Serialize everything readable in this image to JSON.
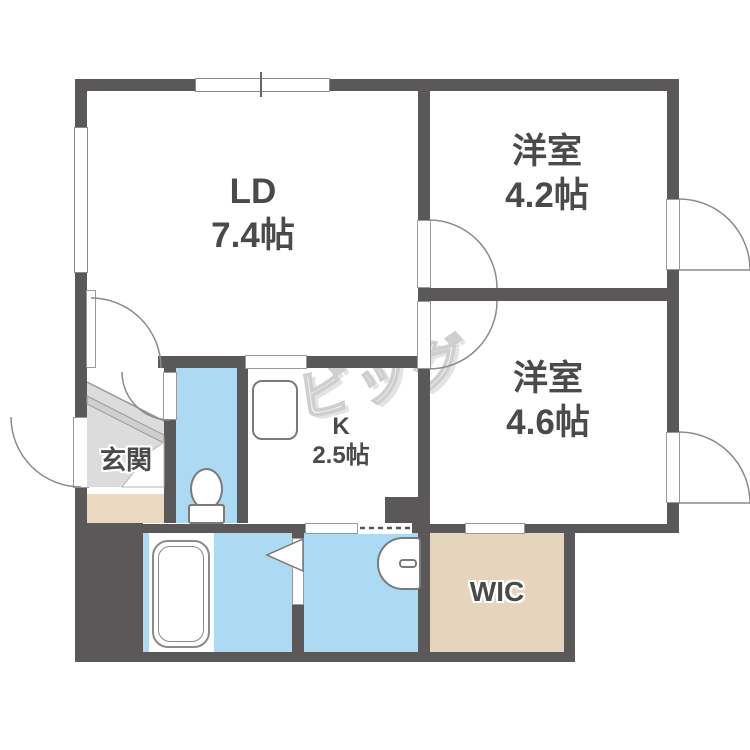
{
  "watermark_text": "ビッグ",
  "rooms": {
    "ld": {
      "name": "LD",
      "size": "7.4帖"
    },
    "west42": {
      "name": "洋室",
      "size": "4.2帖"
    },
    "west46": {
      "name": "洋室",
      "size": "4.6帖"
    },
    "kitchen": {
      "name": "K",
      "size": "2.5帖"
    },
    "entrance": {
      "name": "玄関"
    },
    "wic": {
      "name": "WIC"
    }
  },
  "fixtures": [
    "bathtub",
    "toilet",
    "kitchen-sink",
    "washbasin",
    "staircase",
    "folding-bath-door"
  ],
  "colors": {
    "wall": "#5a5858",
    "water": "#abdaf2",
    "storage": "#e6d4bd",
    "entrance_floor": "#dcdcdc",
    "step": "#ead8c0",
    "label": "#4a4a4a",
    "line": "#8a8a8a",
    "watermark": "#d9d9d9"
  }
}
